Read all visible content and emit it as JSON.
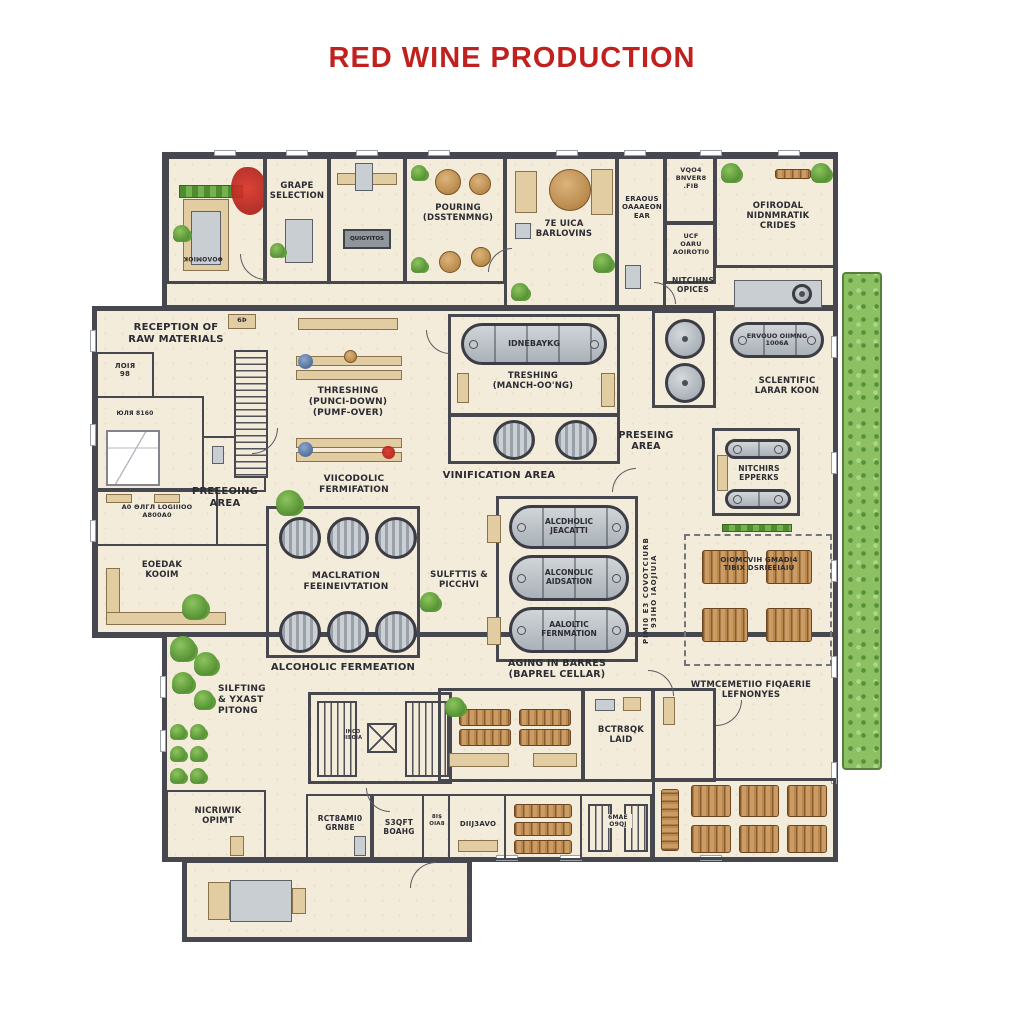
{
  "title": "RED WINE PRODUCTION",
  "colors": {
    "title": "#c0211e",
    "wall": "#474750",
    "floor": "#f3ecda",
    "tank_gray": "#b9bfc4",
    "barrel_brown": "#c99b63",
    "plant_green": "#6fae4b",
    "red_stain": "#c2271f"
  },
  "rooms": {
    "weighing_machine": "ΦOΛOMIOK",
    "grape_selection": "GRAPE\nSELECTION",
    "sorting_machine": "QUIGYITOS",
    "pouring_destemming": "POURING\n(DSSTENMNG)",
    "tasting_room": "7E UICA\nBARLOVINS",
    "bar_room": "ERAOUS\nOAAAEON\nEAR",
    "wood_store": "VQO4\nBNVER8\n.FIB",
    "guard_room": "UCF\nOARU\nAOIROTI0",
    "official_offices": "OFIRODAL\nNIDNMRATIK\nCRIDES",
    "kitchens_offices": "NITCIHNS\nOPICES",
    "reception_raw_materials": "RECEPTION OF\nRAW MATERIALS",
    "room_98": "ЛOIЯ\n98",
    "bed_room": "ЮЛЯ 8160",
    "storage_note": "A0 ΘЛГЛ LOGIIIOO\nA800A0",
    "cedar_room": "EOEDAK\nKOOIM",
    "corridor_tag": "6Þ",
    "pressing_area_left": "PREEEOING\nAREA",
    "threshing_hall": "THRESHING\n(PUNCI-DOWN)\n(PUMF-OVER)",
    "maceration_room": "TRESHING\n(MANCH-OO'NG)",
    "horizontal_tank": "IDNEBAYKG",
    "vinification_area": "VINIFICATION AREA",
    "pressing_area_right": "PRESEING\nAREA",
    "scientific_lab": "SCLENTIFIC\nLARAR KOON",
    "milk_tank": "ERVOUO OIIMNG\n1006A",
    "witchers_room": "NITCHIRS\nEPPERKS",
    "alcoholic_fermentation_top": "VIICODOLIC\nFERMIFATION",
    "maceration_fermentation": "MACLRATION\nFEEINEIVTATION",
    "alcoholic_fermentation_bottom": "ALCOHOLIC FERMEATION",
    "sulfites_pitching": "SULFTTIS &\nPICCHVI",
    "aging_tank_1": "ALCDHOLIC\nJEACATTI",
    "aging_tank_2": "ALCONOLIC\nAIDSATION",
    "aging_tank_3": "AALOLTIC\nFERNMATION",
    "aging_in_barrels": "AGING IN BARRES\n(BAPREL CELLAR)",
    "side_note_vertical": "PIMI0 E3 COVOTCIURB\n93IHO IAOJIUIA",
    "barrel_store_note": "OIOMCVIH GMADI4\nTIBIX DSRIEEIAIU",
    "thematic_storage": "WTMCEMETIIO FIQAERIE\nLEFNONYES",
    "sulfiting_yeast": "SILFTING\n& YXAST\nPITONG",
    "elevator_note": "INCO\nIIEOIA",
    "control_lab": "BCTR8QK\nLAID",
    "network_office": "NICRIWIK\nOPIMT",
    "retaining_room": "RCT8AMI0\nGRN8E",
    "staff_board": "S3QFT\nBOAHG",
    "bis_room": "8I$\nOIA8",
    "divider_room": "DIIJ3AVO",
    "stair_note": "6MAE\nO9QJ"
  }
}
